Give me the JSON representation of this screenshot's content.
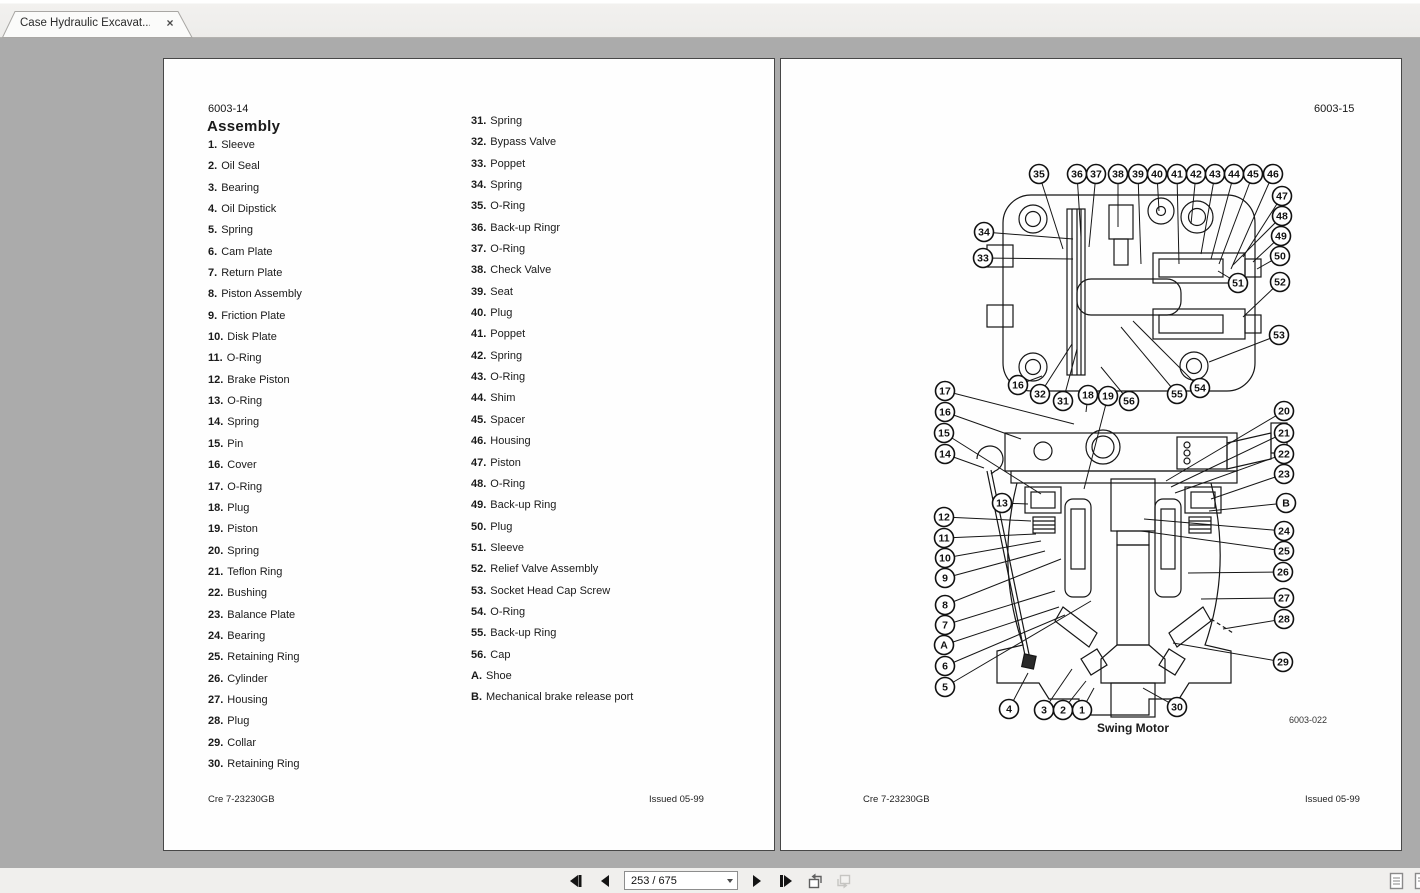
{
  "tab": {
    "title": "Case Hydraulic Excavat...",
    "close_glyph": "×"
  },
  "toolbar": {
    "page_field": "253 / 675",
    "icons": [
      "skip-back-icon",
      "prev-page-icon",
      "next-page-icon",
      "skip-forward-icon",
      "previous-view-icon",
      "next-view-icon",
      "single-page-view-icon",
      "facing-pages-view-icon"
    ]
  },
  "left_page": {
    "page_code": "6003-14",
    "title": "Assembly",
    "items_col1": [
      {
        "num": "1.",
        "label": "Sleeve"
      },
      {
        "num": "2.",
        "label": "Oil Seal"
      },
      {
        "num": "3.",
        "label": "Bearing"
      },
      {
        "num": "4.",
        "label": "Oil Dipstick"
      },
      {
        "num": "5.",
        "label": "Spring"
      },
      {
        "num": "6.",
        "label": "Cam Plate"
      },
      {
        "num": "7.",
        "label": "Return Plate"
      },
      {
        "num": "8.",
        "label": "Piston Assembly"
      },
      {
        "num": "9.",
        "label": "Friction Plate"
      },
      {
        "num": "10.",
        "label": "Disk Plate"
      },
      {
        "num": "11.",
        "label": "O-Ring"
      },
      {
        "num": "12.",
        "label": "Brake Piston"
      },
      {
        "num": "13.",
        "label": "O-Ring"
      },
      {
        "num": "14.",
        "label": "Spring"
      },
      {
        "num": "15.",
        "label": "Pin"
      },
      {
        "num": "16.",
        "label": "Cover"
      },
      {
        "num": "17.",
        "label": "O-Ring"
      },
      {
        "num": "18.",
        "label": "Plug"
      },
      {
        "num": "19.",
        "label": "Piston"
      },
      {
        "num": "20.",
        "label": "Spring"
      },
      {
        "num": "21.",
        "label": "Teflon Ring"
      },
      {
        "num": "22.",
        "label": "Bushing"
      },
      {
        "num": "23.",
        "label": "Balance Plate"
      },
      {
        "num": "24.",
        "label": "Bearing"
      },
      {
        "num": "25.",
        "label": "Retaining Ring"
      },
      {
        "num": "26.",
        "label": "Cylinder"
      },
      {
        "num": "27.",
        "label": "Housing"
      },
      {
        "num": "28.",
        "label": "Plug"
      },
      {
        "num": "29.",
        "label": "Collar"
      },
      {
        "num": "30.",
        "label": "Retaining Ring"
      }
    ],
    "items_col2": [
      {
        "num": "31.",
        "label": "Spring"
      },
      {
        "num": "32.",
        "label": "Bypass Valve"
      },
      {
        "num": "33.",
        "label": "Poppet"
      },
      {
        "num": "34.",
        "label": "Spring"
      },
      {
        "num": "35.",
        "label": "O-Ring"
      },
      {
        "num": "36.",
        "label": "Back-up Ringr"
      },
      {
        "num": "37.",
        "label": "O-Ring"
      },
      {
        "num": "38.",
        "label": "Check Valve"
      },
      {
        "num": "39.",
        "label": "Seat"
      },
      {
        "num": "40.",
        "label": "Plug"
      },
      {
        "num": "41.",
        "label": "Poppet"
      },
      {
        "num": "42.",
        "label": "Spring"
      },
      {
        "num": "43.",
        "label": "O-Ring"
      },
      {
        "num": "44.",
        "label": "Shim"
      },
      {
        "num": "45.",
        "label": "Spacer"
      },
      {
        "num": "46.",
        "label": "Housing"
      },
      {
        "num": "47.",
        "label": "Piston"
      },
      {
        "num": "48.",
        "label": "O-Ring"
      },
      {
        "num": "49.",
        "label": "Back-up Ring"
      },
      {
        "num": "50.",
        "label": "Plug"
      },
      {
        "num": "51.",
        "label": "Sleeve"
      },
      {
        "num": "52.",
        "label": "Relief Valve Assembly"
      },
      {
        "num": "53.",
        "label": "Socket Head Cap Screw"
      },
      {
        "num": "54.",
        "label": "O-Ring"
      },
      {
        "num": "55.",
        "label": "Back-up Ring"
      },
      {
        "num": "56.",
        "label": "Cap"
      },
      {
        "num": "A.",
        "label": "Shoe"
      },
      {
        "num": "B.",
        "label": "Mechanical brake release port"
      }
    ],
    "footer_left": "Cre 7-23230GB",
    "footer_right": "Issued 05-99"
  },
  "right_page": {
    "page_code": "6003-15",
    "caption": "Swing Motor",
    "figure_code": "6003-022",
    "footer_left": "Cre 7-23230GB",
    "footer_right": "Issued 05-99",
    "callouts": [
      {
        "label": "35",
        "x": 258,
        "y": 115,
        "tx": 282,
        "ty": 190
      },
      {
        "label": "36",
        "x": 296,
        "y": 115,
        "tx": 300,
        "ty": 178
      },
      {
        "label": "37",
        "x": 315,
        "y": 115,
        "tx": 308,
        "ty": 188
      },
      {
        "label": "38",
        "x": 337,
        "y": 115,
        "tx": 337,
        "ty": 168
      },
      {
        "label": "39",
        "x": 357,
        "y": 115,
        "tx": 360,
        "ty": 205
      },
      {
        "label": "40",
        "x": 376,
        "y": 115,
        "tx": 378,
        "ty": 152
      },
      {
        "label": "41",
        "x": 396,
        "y": 115,
        "tx": 398,
        "ty": 205
      },
      {
        "label": "42",
        "x": 415,
        "y": 115,
        "tx": 410,
        "ty": 165
      },
      {
        "label": "43",
        "x": 434,
        "y": 115,
        "tx": 420,
        "ty": 195
      },
      {
        "label": "44",
        "x": 453,
        "y": 115,
        "tx": 430,
        "ty": 200
      },
      {
        "label": "45",
        "x": 472,
        "y": 115,
        "tx": 438,
        "ty": 205
      },
      {
        "label": "46",
        "x": 492,
        "y": 115,
        "tx": 450,
        "ty": 210
      },
      {
        "label": "47",
        "x": 501,
        "y": 137,
        "tx": 462,
        "ty": 198
      },
      {
        "label": "48",
        "x": 501,
        "y": 157,
        "tx": 452,
        "ty": 206
      },
      {
        "label": "49",
        "x": 500,
        "y": 177,
        "tx": 472,
        "ty": 203
      },
      {
        "label": "50",
        "x": 499,
        "y": 197,
        "tx": 476,
        "ty": 210
      },
      {
        "label": "51",
        "x": 457,
        "y": 224,
        "tx": 437,
        "ty": 212
      },
      {
        "label": "52",
        "x": 499,
        "y": 223,
        "tx": 462,
        "ty": 258
      },
      {
        "label": "53",
        "x": 498,
        "y": 276,
        "tx": 428,
        "ty": 303
      },
      {
        "label": "54",
        "x": 419,
        "y": 329,
        "tx": 352,
        "ty": 262
      },
      {
        "label": "55",
        "x": 396,
        "y": 335,
        "tx": 340,
        "ty": 268
      },
      {
        "label": "56",
        "x": 348,
        "y": 342,
        "tx": 320,
        "ty": 308
      },
      {
        "label": "34",
        "x": 203,
        "y": 173,
        "tx": 292,
        "ty": 180
      },
      {
        "label": "33",
        "x": 202,
        "y": 199,
        "tx": 292,
        "ty": 200
      },
      {
        "label": "16",
        "x": 237,
        "y": 326,
        "tx": 261,
        "ty": 317
      },
      {
        "label": "32",
        "x": 259,
        "y": 335,
        "tx": 291,
        "ty": 285
      },
      {
        "label": "31",
        "x": 282,
        "y": 342,
        "tx": 296,
        "ty": 290
      },
      {
        "label": "18",
        "x": 307,
        "y": 336,
        "tx": 305,
        "ty": 353
      },
      {
        "label": "19",
        "x": 327,
        "y": 337,
        "tx": 303,
        "ty": 430
      },
      {
        "label": "17",
        "x": 164,
        "y": 332,
        "tx": 293,
        "ty": 365
      },
      {
        "label": "16",
        "x": 164,
        "y": 353,
        "tx": 240,
        "ty": 380
      },
      {
        "label": "15",
        "x": 163,
        "y": 374,
        "tx": 260,
        "ty": 435
      },
      {
        "label": "14",
        "x": 164,
        "y": 395,
        "tx": 203,
        "ty": 409
      },
      {
        "label": "13",
        "x": 221,
        "y": 444,
        "tx": 247,
        "ty": 445
      },
      {
        "label": "12",
        "x": 163,
        "y": 458,
        "tx": 250,
        "ty": 462
      },
      {
        "label": "11",
        "x": 163,
        "y": 479,
        "tx": 255,
        "ty": 475
      },
      {
        "label": "10",
        "x": 164,
        "y": 499,
        "tx": 260,
        "ty": 482
      },
      {
        "label": "9",
        "x": 164,
        "y": 519,
        "tx": 264,
        "ty": 492
      },
      {
        "label": "8",
        "x": 164,
        "y": 546,
        "tx": 280,
        "ty": 500
      },
      {
        "label": "7",
        "x": 164,
        "y": 566,
        "tx": 274,
        "ty": 532
      },
      {
        "label": "A",
        "x": 163,
        "y": 586,
        "tx": 278,
        "ty": 548
      },
      {
        "label": "6",
        "x": 164,
        "y": 607,
        "tx": 284,
        "ty": 556
      },
      {
        "label": "5",
        "x": 164,
        "y": 628,
        "tx": 310,
        "ty": 542
      },
      {
        "label": "4",
        "x": 228,
        "y": 650,
        "tx": 247,
        "ty": 614
      },
      {
        "label": "3",
        "x": 263,
        "y": 651,
        "tx": 291,
        "ty": 610
      },
      {
        "label": "2",
        "x": 282,
        "y": 651,
        "tx": 305,
        "ty": 622
      },
      {
        "label": "1",
        "x": 301,
        "y": 651,
        "tx": 313,
        "ty": 629
      },
      {
        "label": "30",
        "x": 396,
        "y": 648,
        "tx": 362,
        "ty": 629
      },
      {
        "label": "20",
        "x": 503,
        "y": 352,
        "tx": 385,
        "ty": 422
      },
      {
        "label": "21",
        "x": 503,
        "y": 374,
        "tx": 390,
        "ty": 428
      },
      {
        "label": "22",
        "x": 503,
        "y": 395,
        "tx": 394,
        "ty": 434
      },
      {
        "label": "23",
        "x": 503,
        "y": 415,
        "tx": 430,
        "ty": 440
      },
      {
        "label": "B",
        "x": 505,
        "y": 444,
        "tx": 428,
        "ty": 452
      },
      {
        "label": "24",
        "x": 503,
        "y": 472,
        "tx": 363,
        "ty": 460
      },
      {
        "label": "25",
        "x": 503,
        "y": 492,
        "tx": 360,
        "ty": 472
      },
      {
        "label": "26",
        "x": 502,
        "y": 513,
        "tx": 407,
        "ty": 514
      },
      {
        "label": "27",
        "x": 503,
        "y": 539,
        "tx": 420,
        "ty": 540
      },
      {
        "label": "28",
        "x": 503,
        "y": 560,
        "tx": 442,
        "ty": 570
      },
      {
        "label": "29",
        "x": 502,
        "y": 603,
        "tx": 392,
        "ty": 584
      }
    ]
  }
}
